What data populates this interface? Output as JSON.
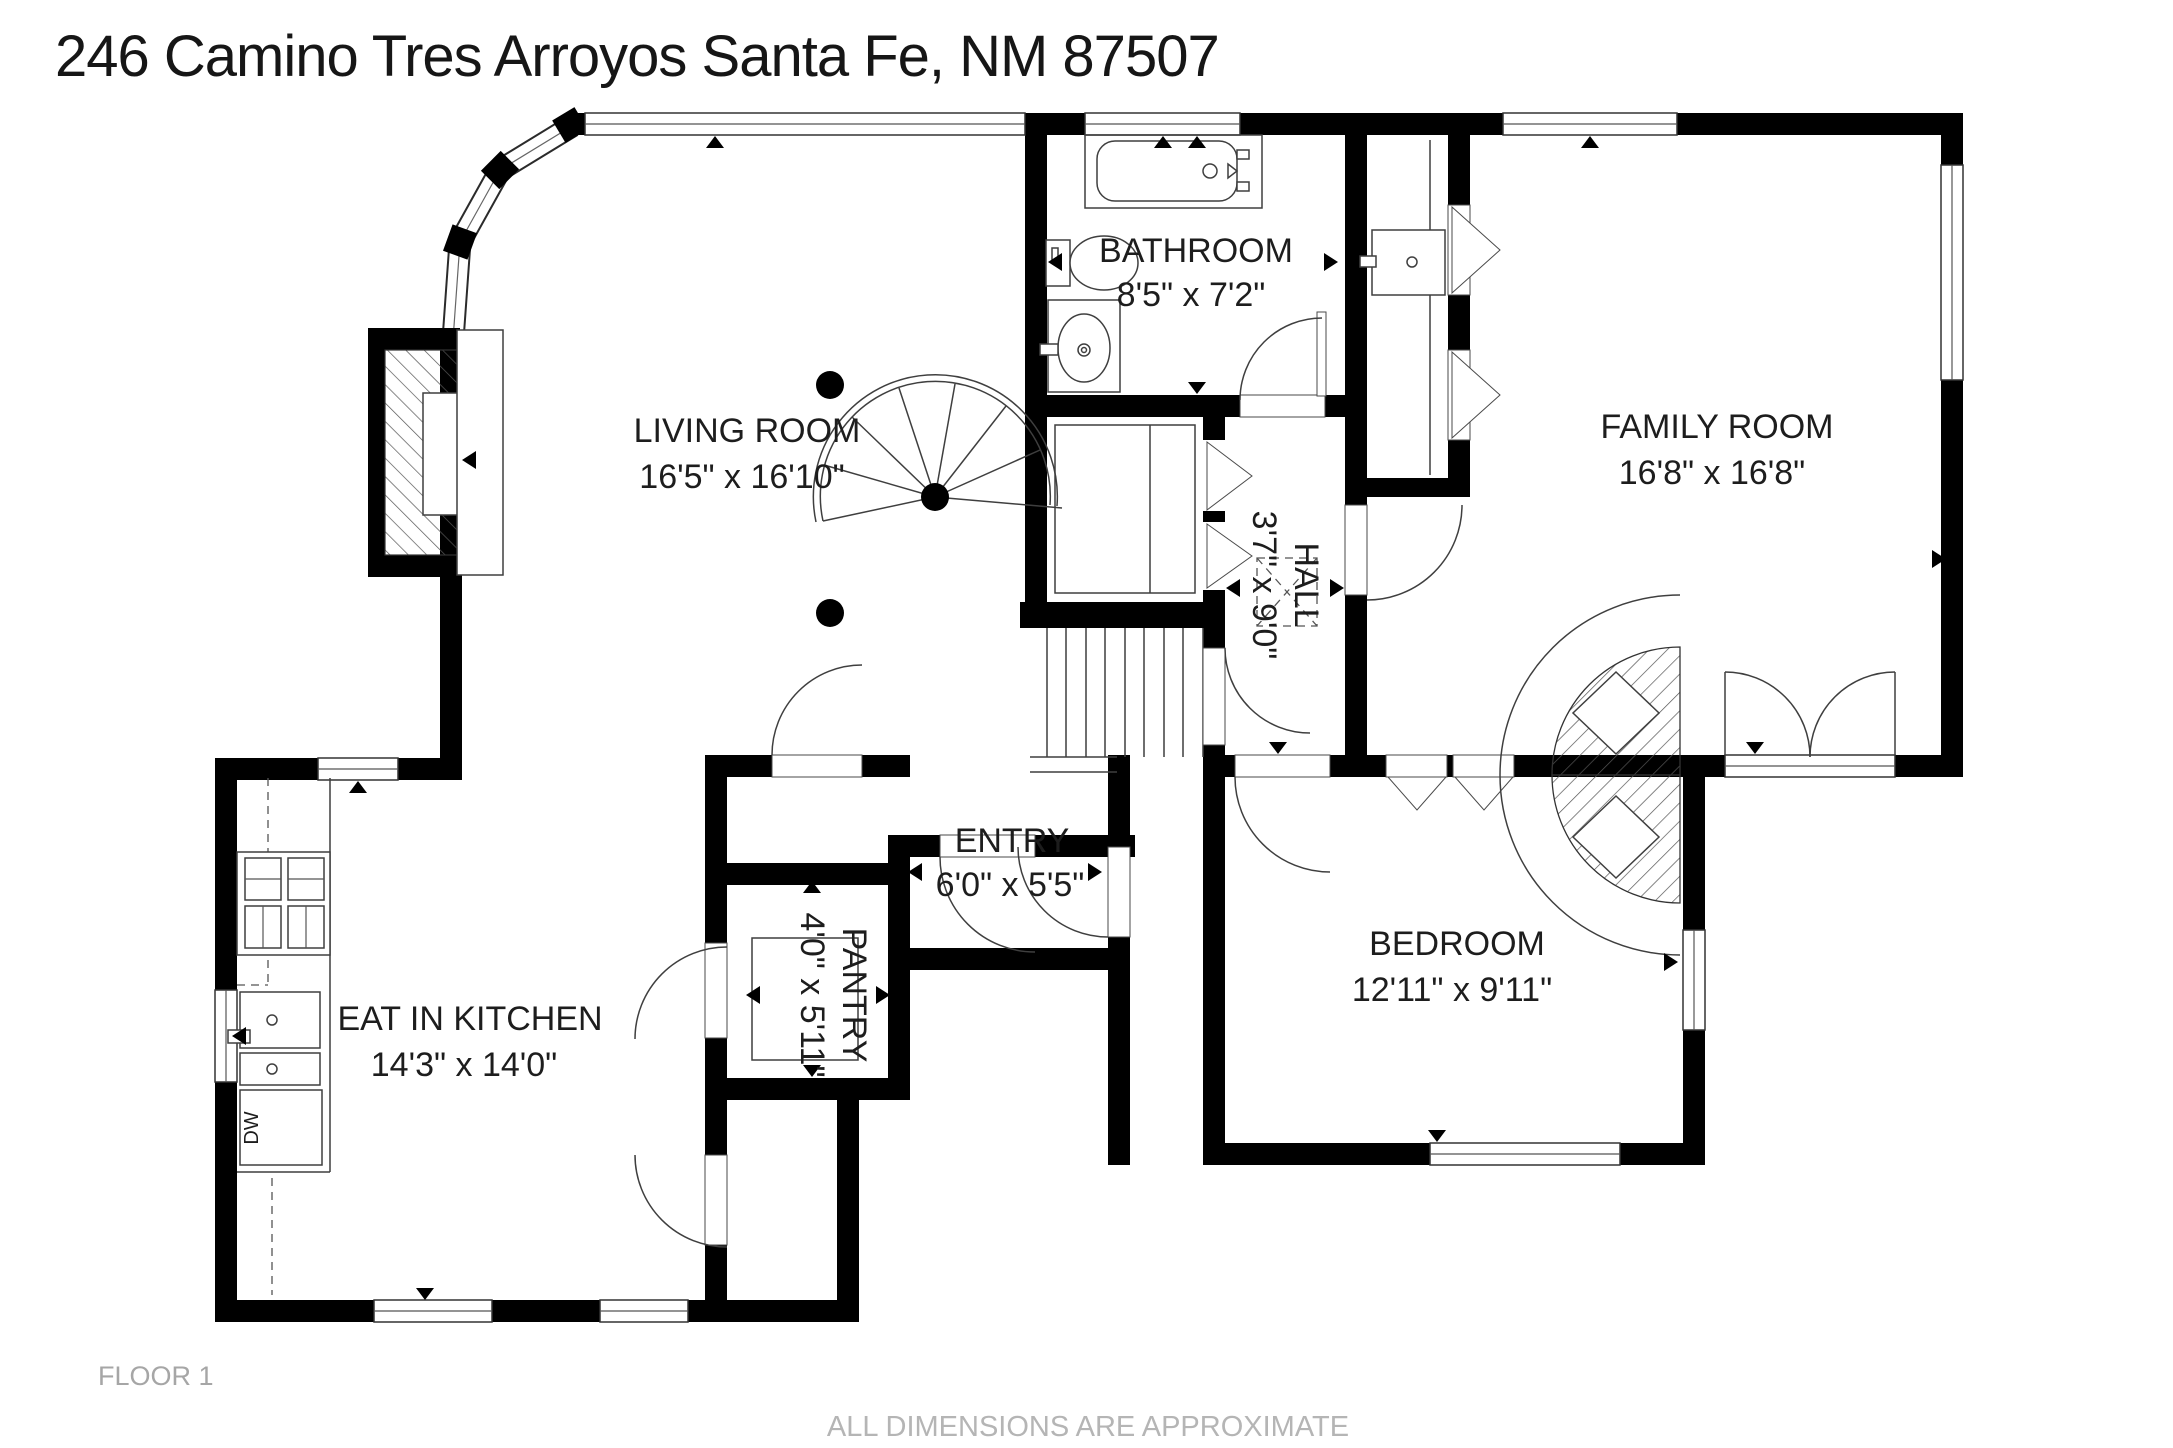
{
  "title": "246 Camino Tres Arroyos Santa Fe, NM 87507",
  "rooms": {
    "living_room": {
      "name": "LIVING ROOM",
      "dims": "16'5\" x 16'10\""
    },
    "bathroom": {
      "name": "BATHROOM",
      "dims": "8'5\" x 7'2\""
    },
    "family_room": {
      "name": "FAMILY ROOM",
      "dims": "16'8\" x 16'8\""
    },
    "hall": {
      "name": "HALL",
      "dims": "3'7\" x 9'0\""
    },
    "entry": {
      "name": "ENTRY",
      "dims": "6'0\" x 5'5\""
    },
    "pantry": {
      "name": "PANTRY",
      "dims": "4'0\" x 5'11\""
    },
    "kitchen": {
      "name": "EAT IN KITCHEN",
      "dims": "14'3\" x 14'0\""
    },
    "bedroom": {
      "name": "BEDROOM",
      "dims": "12'11\" x 9'11\""
    }
  },
  "labels": {
    "dishwasher": "DW"
  },
  "footer": {
    "floor": "FLOOR 1",
    "disclaimer": "ALL DIMENSIONS ARE APPROXIMATE"
  },
  "colors": {
    "wall": "#000000",
    "line": "#3f3f3f",
    "muted": "#a6a6a6"
  }
}
